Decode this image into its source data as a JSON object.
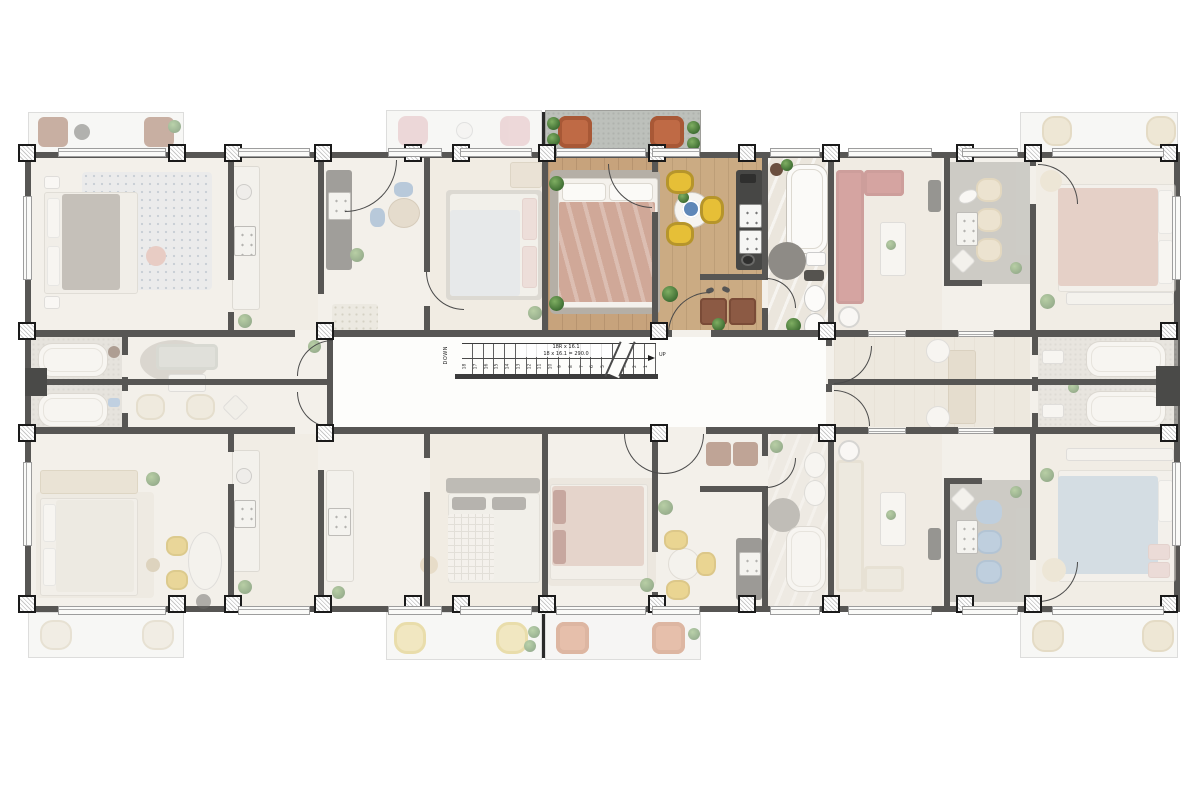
{
  "plan": {
    "kind": "apartment-building-floor-plan",
    "core_label": "stair-core",
    "units": [
      {
        "id": "top-left",
        "highlighted": false,
        "rooms": [
          "bedroom",
          "kitchen",
          "hall"
        ]
      },
      {
        "id": "top-center-left",
        "highlighted": false,
        "rooms": [
          "kitchen-dining",
          "bedroom",
          "entry"
        ]
      },
      {
        "id": "top-center",
        "highlighted": true,
        "rooms": [
          "balcony",
          "bedroom",
          "kitchen-dining",
          "entry",
          "bathroom"
        ]
      },
      {
        "id": "top-right-living",
        "highlighted": false,
        "rooms": [
          "living",
          "kitchen"
        ]
      },
      {
        "id": "top-right-bedroom",
        "highlighted": false,
        "rooms": [
          "bedroom"
        ]
      },
      {
        "id": "middle-left",
        "highlighted": false,
        "rooms": [
          "bathroom",
          "bathroom",
          "lounge"
        ]
      },
      {
        "id": "middle-right",
        "highlighted": false,
        "rooms": [
          "corridor",
          "bathroom",
          "bathroom"
        ]
      },
      {
        "id": "bottom-left",
        "highlighted": false,
        "rooms": [
          "bedroom",
          "dining",
          "kitchen"
        ]
      },
      {
        "id": "bottom-center-left",
        "highlighted": false,
        "rooms": [
          "kitchen",
          "bedroom"
        ]
      },
      {
        "id": "bottom-center",
        "highlighted": false,
        "rooms": [
          "bedroom",
          "entry",
          "dining-kitchen",
          "bathroom"
        ]
      },
      {
        "id": "bottom-right-living",
        "highlighted": false,
        "rooms": [
          "living",
          "kitchen"
        ]
      },
      {
        "id": "bottom-right-bedroom",
        "highlighted": false,
        "rooms": [
          "bedroom"
        ]
      }
    ]
  },
  "stairs": {
    "down_label": "DOWN",
    "up_label": "UP",
    "annotation_line1": "18R x 16.1",
    "annotation_line2": "18 x 16.1 = 290.0",
    "tread_numbers": [
      "18",
      "17",
      "16",
      "15",
      "14",
      "13",
      "12",
      "11",
      "10",
      "9",
      "8",
      "7",
      "6",
      "5",
      "4",
      "3",
      "2",
      "1"
    ]
  },
  "palette": {
    "wall": "#575654",
    "slab_floor": "#f3f0ea",
    "highlight_wood": "#c7a37c",
    "highlight_kitchen_wood": "#cbab83",
    "marble": "#ebe6dd",
    "balcony_concrete": "#bdc0bb",
    "bed_blanket_pink": "#d0a898",
    "bed_blanket_blue": "#b7cbdd",
    "chair_yellow": "#e6bf37",
    "chair_terracotta": "#bf6a45",
    "chair_blue": "#8cb0d3",
    "chair_cream": "#e7d8b7",
    "kitchen_counter_dark": "#474745",
    "sofa_red": "#b95b5b",
    "sofa_cream": "#e9e3d6",
    "plant_green": "#4c7a3b",
    "rug_gray": "#b5afa6"
  }
}
